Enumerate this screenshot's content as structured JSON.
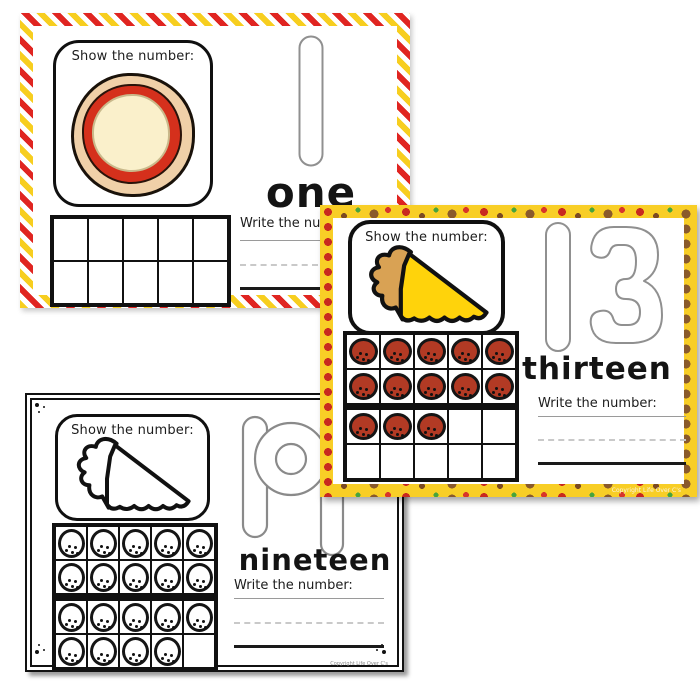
{
  "cards": [
    {
      "title": "number-one-mat",
      "show_label": "Show the number:",
      "numeral": "1",
      "number_word": "one",
      "write_label": "Write the number:",
      "ten_frames": [
        {
          "filled": 0,
          "total": 10
        }
      ]
    },
    {
      "title": "number-thirteen-mat",
      "show_label": "Show the number:",
      "numeral": "13",
      "digit_parts": [
        "1",
        "3"
      ],
      "number_word": "thirteen",
      "write_label": "Write the number:",
      "ten_frames": [
        {
          "filled": 10,
          "total": 10
        },
        {
          "filled": 3,
          "total": 10
        }
      ],
      "copyright": "Copyright Life Over C's"
    },
    {
      "title": "number-nineteen-mat",
      "show_label": "Show the number:",
      "numeral": "19",
      "digit_parts": [
        "1",
        "9"
      ],
      "number_word": "nineteen",
      "write_label": "Write the number:",
      "ten_frames": [
        {
          "filled": 10,
          "total": 10
        },
        {
          "filled": 9,
          "total": 10
        }
      ],
      "copyright": "Copyright Life Over C's"
    }
  ],
  "colors": {
    "chevron_yellow": "#F7CE1F",
    "chevron_red": "#E02521",
    "pizza_border_yellow": "#F8CE26",
    "pepperoni": "#B23A24",
    "slice_cheese": "#FFD30B",
    "slice_crust": "#D9A254",
    "whole_pizza_crust": "#F0D0A8",
    "whole_pizza_sauce": "#D5301C",
    "whole_pizza_cheese": "#FAF0CB",
    "digit_outline": "#909090"
  }
}
